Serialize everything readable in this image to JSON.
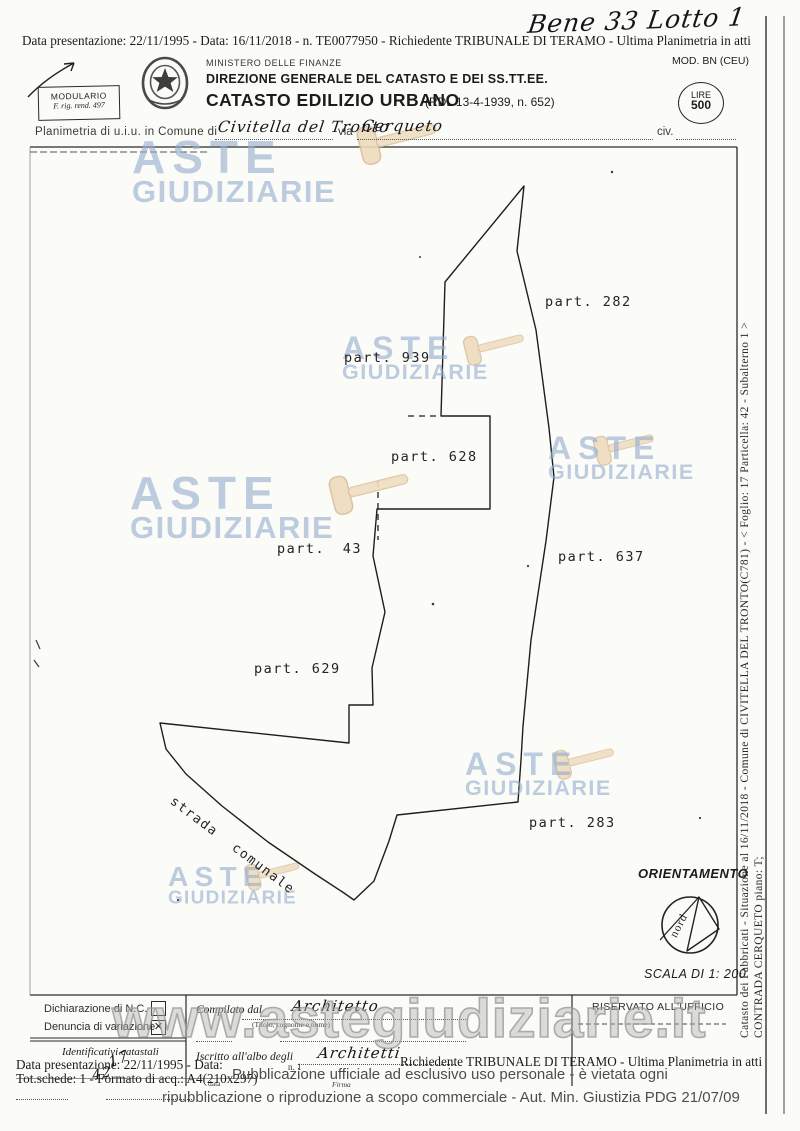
{
  "annotations": {
    "handwritten_title": "Bene 33 Lotto 1",
    "handwritten_id1": "17",
    "handwritten_id2": "42"
  },
  "header": {
    "presentation_line": "Data presentazione: 22/11/1995 - Data: 16/11/2018 -  n. TE0077950 - Richiedente TRIBUNALE DI TERAMO - Ultima Planimetria in atti",
    "modulario_line1": "MODULARIO",
    "modulario_line2": "F. rig. rend. 497",
    "ministry": "MINISTERO DELLE FINANZE",
    "direction": "DIREZIONE GENERALE DEL CATASTO E DEI SS.TT.EE.",
    "office": "CATASTO EDILIZIO URBANO",
    "office_ref": "(RDL 13-4-1939, n. 652)",
    "mod_label": "MOD. BN (CEU)",
    "stamp_line1": "LIRE",
    "stamp_line2": "500"
  },
  "location_line": {
    "prefix": "Planimetria di u.i.u. in Comune di",
    "comune": "Civitella del Tronto",
    "via_label": "via",
    "via": "Cerqueto",
    "civ_label": "civ."
  },
  "map": {
    "parcels": [
      {
        "label": "part. 282"
      },
      {
        "label": "part. 939"
      },
      {
        "label": "part. 628"
      },
      {
        "label": "part. 43"
      },
      {
        "label": "part. 637"
      },
      {
        "label": "part. 629"
      },
      {
        "label": "part. 283"
      }
    ],
    "road_label": "strada comunale",
    "orientation_label": "ORIENTAMENTO",
    "compass_label": "nord",
    "scale_label": "SCALA DI 1: 200"
  },
  "sidebar_vertical": {
    "line1": "Catasto dei Fabbricati - Situazione al 16/11/2018 - Comune di CIVITELLA DEL TRONTO(C781) - < Foglio: 17 Particella: 42 - Subalterno 1 >",
    "line2": "CONTRADA CERQUETO piano: T;"
  },
  "form": {
    "declaration_nc": "Dichiarazione di N.C.",
    "variation": "Denuncia di variazione",
    "checkbox_mark": "✕",
    "identifiers_label": "Identificativi catastali",
    "compiled_by_label": "Compilato dal",
    "compiled_by_value": "Architetto",
    "compiled_by_hint": "(Titolo, cognome e nome)",
    "registered_label": "Iscritto all'albo degli",
    "registered_value": "Architetti",
    "number_label": "n. 1",
    "data_label": "data",
    "firma_label": "Firma",
    "office_reserved": "RISERVATO ALL'UFFICIO"
  },
  "footer": {
    "presentation_left": "Data presentazione: 22/11/1995 - Data:",
    "presentation_right": "Richiedente TRIBUNALE DI TERAMO - Ultima Planimetria in atti",
    "tot_line": "Tot.schede: 1 - Formato di acq.: A4(210x297)",
    "notice_line1": "Pubblicazione ufficiale ad esclusivo uso personale - è vietata ogni",
    "notice_line2": "ripubblicazione o riproduzione a scopo commerciale - Aut. Min. Giustizia PDG 21/07/09",
    "watermark_url": "www.astegiudiziarie.it"
  },
  "watermark": {
    "line1": "ASTE",
    "line2": "GIUDIZIARIE"
  },
  "colors": {
    "watermark_blue": "#94aece",
    "gavel_tan": "#eedbbd",
    "ink": "#1c1c1c"
  }
}
